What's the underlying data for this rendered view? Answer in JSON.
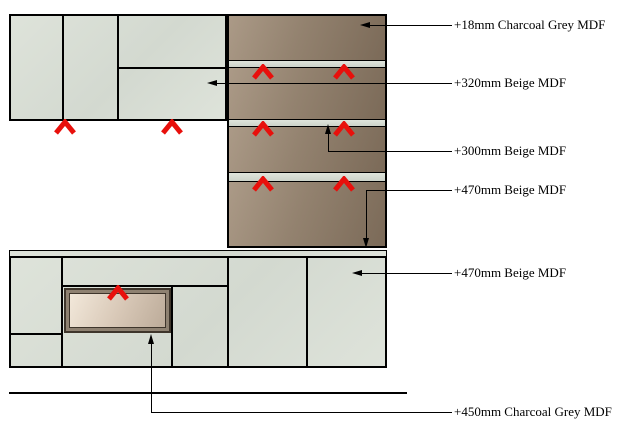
{
  "colors": {
    "bg": "#ffffff",
    "outline": "#000000",
    "panel-a": "#dee3da",
    "panel-b": "#d3d9d0",
    "brown-a": "#ab9a87",
    "brown-b": "#93826f",
    "brown-c": "#7b6a58",
    "band-a": "#dfe4db",
    "band-b": "#ccd3c9",
    "hob-frame": "#3e352b",
    "hob-mid": "#8e8171",
    "hob-a": "#f2e8da",
    "hob-b": "#bcab99",
    "chevron": "#e8100c"
  },
  "icons": {
    "red-chevron": "∧",
    "arrow-left": "◀",
    "arrow-up": "▲",
    "arrow-down": "▼"
  },
  "callouts": [
    {
      "label": "+18mm Charcoal Grey MDF"
    },
    {
      "label": "+320mm Beige MDF"
    },
    {
      "label": "+300mm Beige MDF"
    },
    {
      "label": "+470mm Beige MDF"
    },
    {
      "label": "+470mm Beige MDF"
    },
    {
      "label": "+450mm Charcoal Grey MDF"
    }
  ]
}
